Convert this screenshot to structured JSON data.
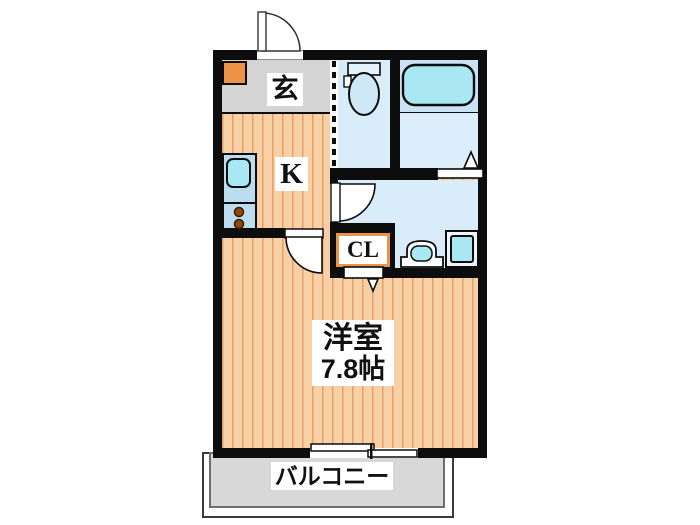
{
  "floor_plan": {
    "type": "apartment-floorplan-1K",
    "entrance": {
      "label": "玄"
    },
    "kitchen": {
      "label": "K"
    },
    "closet": {
      "label": "CL"
    },
    "main_room": {
      "label": "洋室",
      "area": "7.8帖"
    },
    "balcony": {
      "label": "バルコニー"
    },
    "fixtures": [
      "entrance-door-icon",
      "shoe-cabinet-icon",
      "toilet-icon",
      "bathtub-icon",
      "bathroom-door-icon",
      "washroom-door-icon",
      "washbasin-icon",
      "washing-machine-pan-icon",
      "kitchen-sink-icon",
      "stove-burners-icon",
      "room-door-icon",
      "closet-door-icon",
      "sliding-window-icon",
      "dashed-partition-icon"
    ],
    "colors": {
      "wall": "#0d0d0d",
      "floor_orange": "#f7d0a6",
      "floor_stripe": "#e9a066",
      "entrance_gray": "#d4d4d4",
      "shoe_cabinet_orange": "#ef9447",
      "wet_room_blue": "#d9ecfa",
      "bath_upper_blue": "#c9e2f4",
      "bath_lower_blue": "#dcedfb",
      "fixture_cyan": "#a9e8f2",
      "kitchen_counter_blue": "#bcdcf0",
      "burner_brown": "#8f4a12",
      "balcony_gray": "#d8d8d8",
      "closet_frame_orange": "#e8944a"
    }
  }
}
